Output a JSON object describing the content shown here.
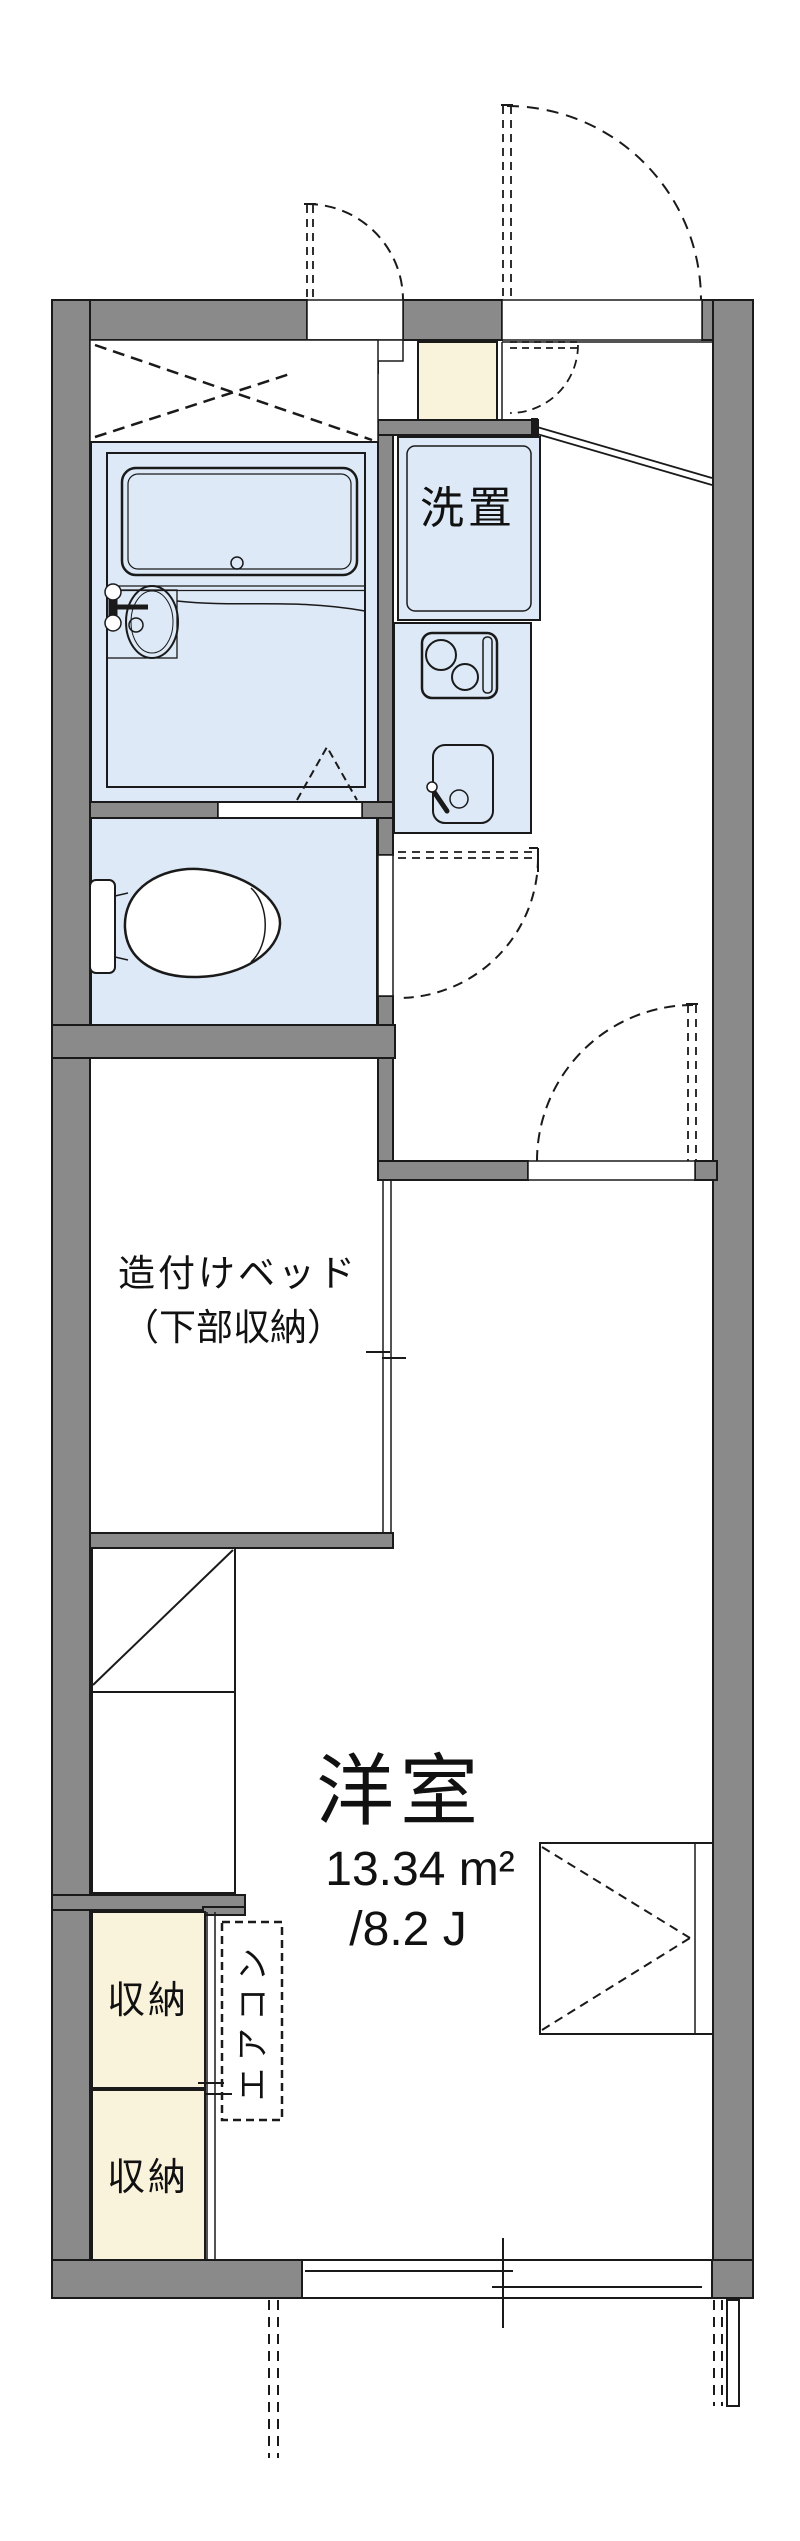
{
  "floor_plan": {
    "rooms": {
      "washer": {
        "label": "洗置"
      },
      "bed": {
        "label_line1": "造付けベッド",
        "label_line2": "（下部収納）"
      },
      "main_room": {
        "name": "洋室",
        "area_m2": "13.34 m²",
        "area_tatami": "/8.2 J"
      },
      "storage_upper": {
        "label": "収納"
      },
      "storage_lower": {
        "label": "収納"
      },
      "aircon": {
        "label": "エアコン"
      }
    },
    "colors": {
      "wall": "#8a8a8a",
      "fixture_fill": "#dde9f7",
      "storage_fill": "#faf3dc",
      "line": "#1a1a1a",
      "background": "#ffffff"
    }
  }
}
